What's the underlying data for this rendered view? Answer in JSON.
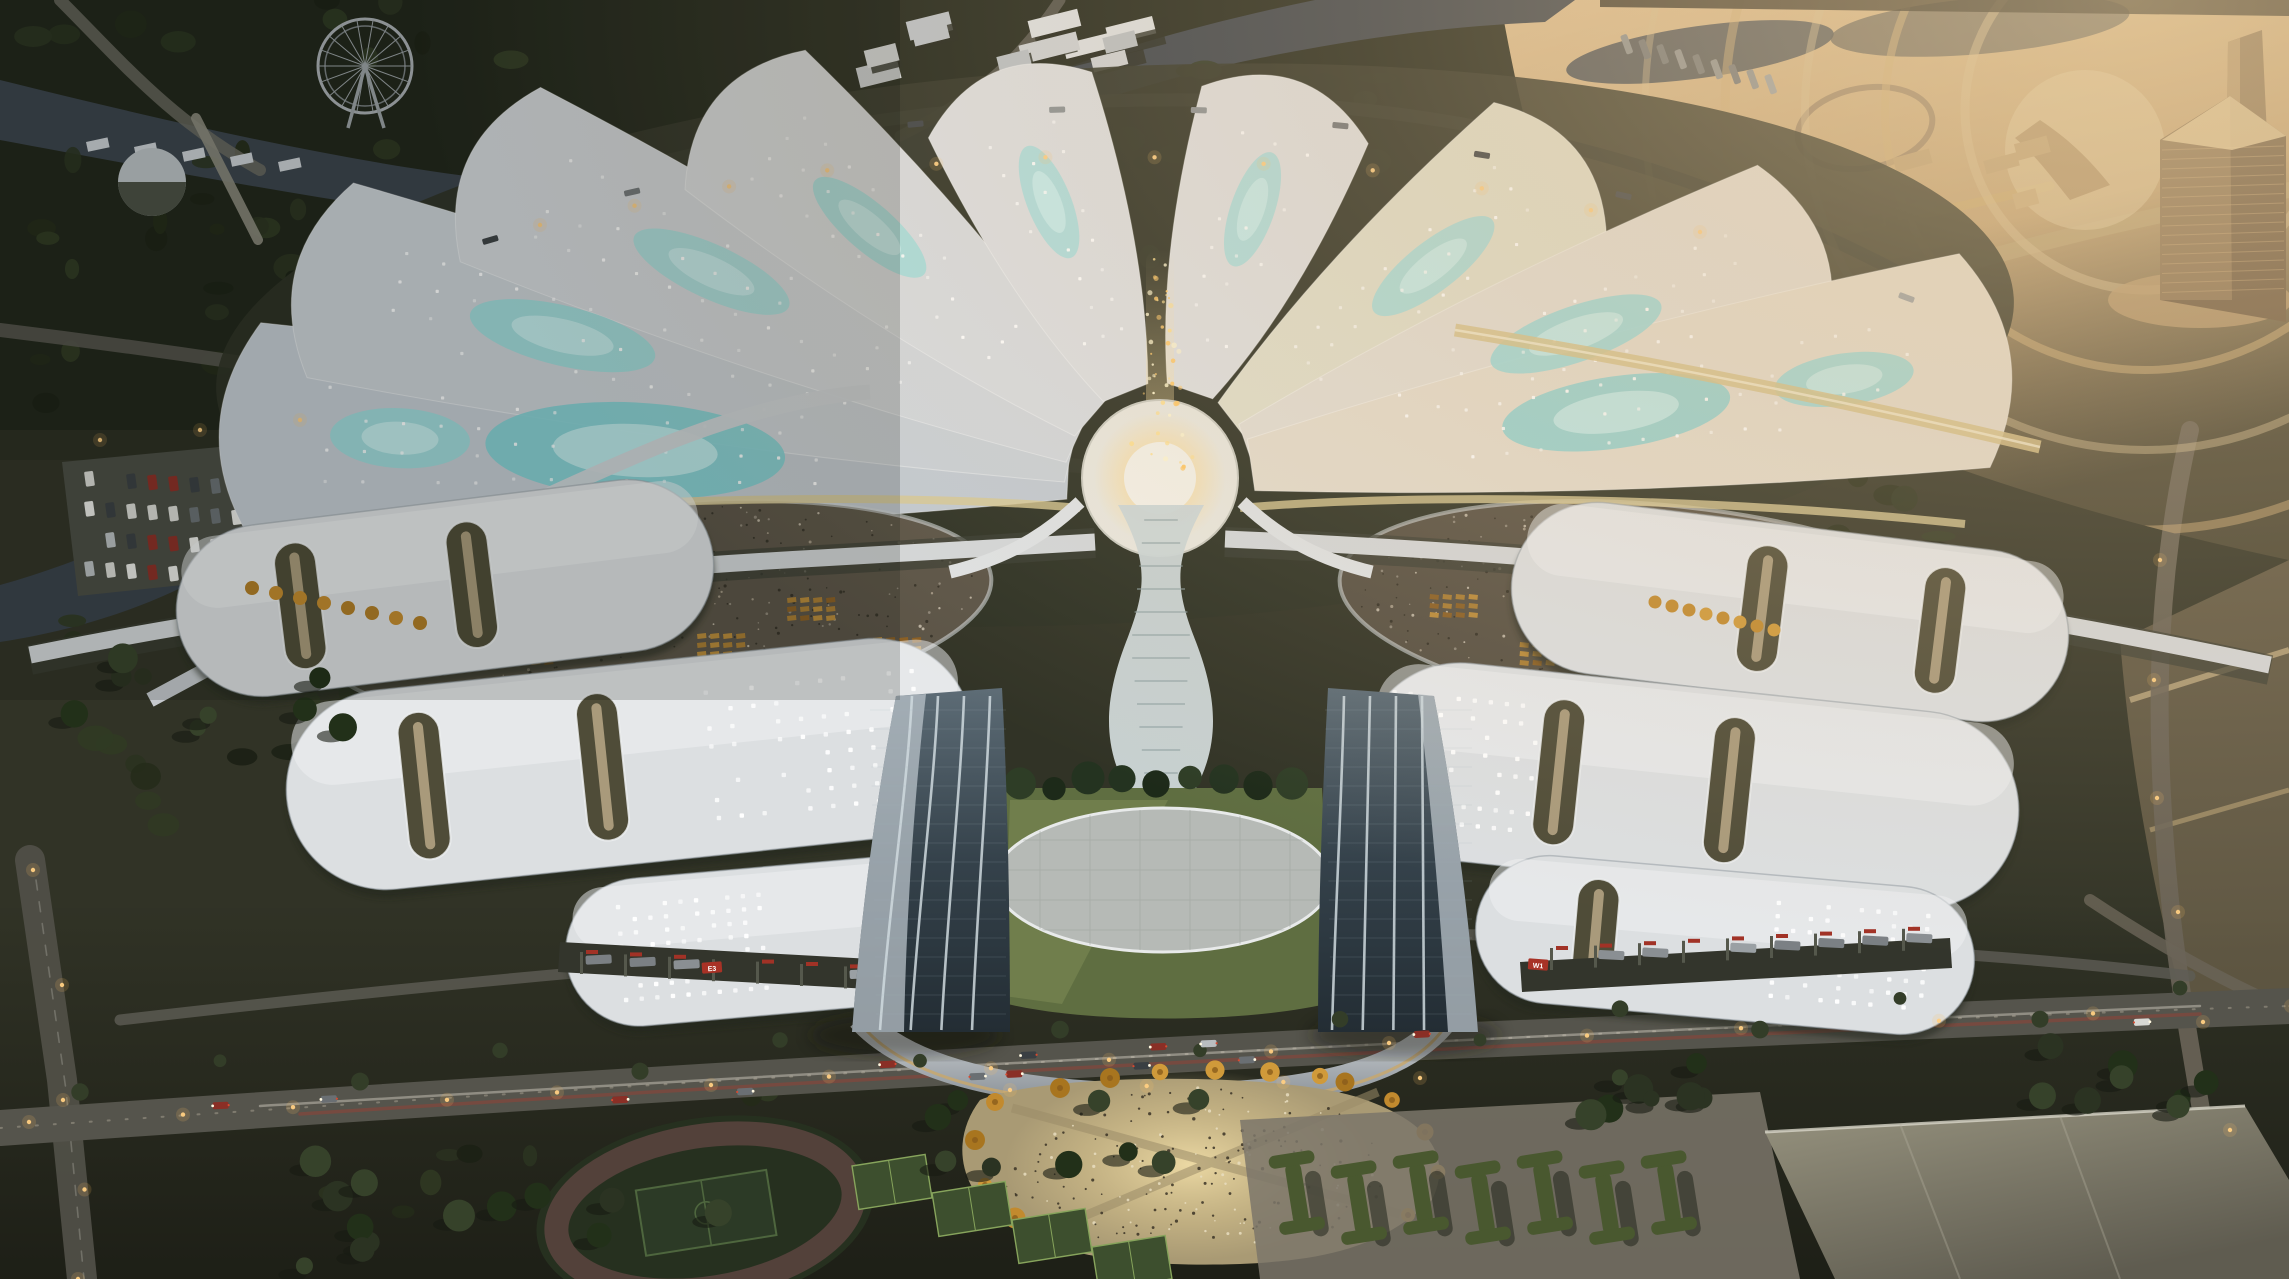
{
  "scene": {
    "type": "architectural aerial rendering",
    "subject": "flower-shaped exhibition and convention center at dusk",
    "setting": "riverfront parkland, ferris wheel at upper left, sunset-lit district with high-rise towers at upper right, sports park at bottom",
    "landmarks": {
      "fan_hall_petals": 9,
      "twin_towers": 2,
      "central_fountain": 1,
      "ferris_wheel": 1,
      "athletic_track": 1,
      "tennis_courts": 4
    }
  },
  "signs": {
    "left_dock": "E3",
    "right_dock": "W1"
  },
  "palette": {
    "ground_base": "#2e3024",
    "ground_dark": "#1d2016",
    "forest": "#222818",
    "forest_light": "#39452a",
    "river": "#3a424b",
    "river_deep": "#2e353d",
    "gold_ground": "#c9a878",
    "gold_light": "#e6cfa2",
    "road": "#5e5d55",
    "road_light": "#9a9488",
    "path_pink": "#7d6a5a",
    "petal_cool": "#c6ccd2",
    "petal_white": "#dcdee0",
    "petal_warm": "#e4dccd",
    "teal": "#9ad8d8",
    "teal_bright": "#bdeef0",
    "hub": "#eae7dd",
    "glow": "#ffd98c",
    "crowd": "#5b5447",
    "booth": "#a87c33",
    "hall_white": "#dcdfe1",
    "hall_shadow": "#a9aeb4",
    "opening": "#4f4c38",
    "opening_strip": "#b3a383",
    "dock_dark": "#33352c",
    "dock_red": "#a83226",
    "tower_glass": "#35424b",
    "tower_glass_light": "#5d6c76",
    "tower_edge": "#cfd9de",
    "lawn": "#5f6e41",
    "lawn_light": "#7e8d55",
    "plaza_oval": "#b6bab6",
    "podium": "#c9ccd0",
    "plaza_gold": "#b3a278",
    "plaza_glow": "#e2cf97",
    "tree_gold": "#c28a2e",
    "tree_dark": "#2b3322",
    "track": "#53413a",
    "pitch": "#2c3a26",
    "court": "#3d4f2e",
    "court_line": "#87a45c",
    "big_roof": "#8a877a",
    "light_warm": "#ffcf82",
    "car_red": "#b43a2a",
    "streak_white": "#e8e4d8",
    "water_gold": "#8d7b5f",
    "white_dot": "#ffffff"
  },
  "counts": {
    "petals": 9,
    "petal_dot_rows": 12,
    "crowd_dots_per_oval": 380,
    "plaza_crowd_dots": 210,
    "forest_blobs": 170,
    "street_lights": 46,
    "cars_main_road": 14,
    "fountain_particles": 48,
    "booth_clusters_per_oval": 6,
    "parking_cars": 34,
    "hedge_islands": 7,
    "ferris_spokes": 18
  },
  "seed": 11
}
